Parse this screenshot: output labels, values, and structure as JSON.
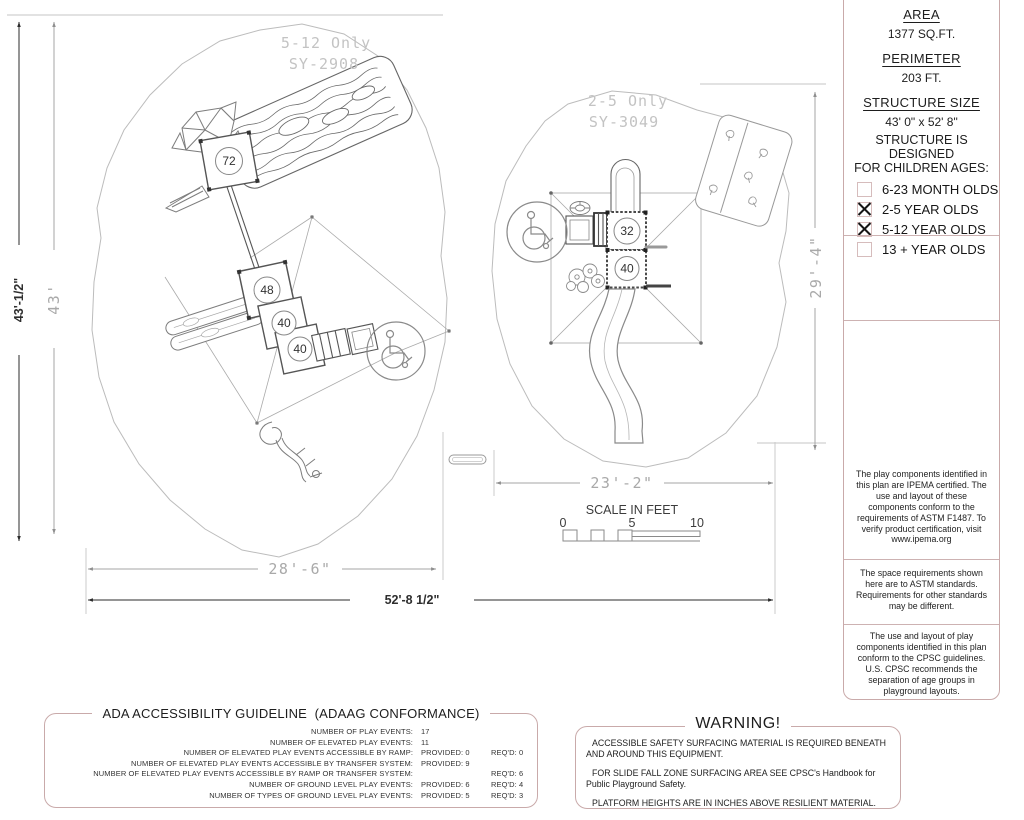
{
  "colors": {
    "box_border": "#c9aaaa",
    "drawing_gray": "#b8b8b8",
    "dim_dark": "#2e2e2e",
    "dim_gray": "#a8a8a8",
    "cad_label": "#c3c3c3"
  },
  "sidebar": {
    "area_label": "AREA",
    "area_value": "1377 SQ.FT.",
    "perimeter_label": "PERIMETER",
    "perimeter_value": "203 FT.",
    "size_label": "STRUCTURE SIZE",
    "size_value": "43' 0\" x 52' 8\"",
    "designed_line1": "STRUCTURE IS DESIGNED",
    "designed_line2": "FOR CHILDREN AGES:",
    "ages": [
      {
        "label": "6-23 MONTH OLDS",
        "checked": false
      },
      {
        "label": "2-5 YEAR OLDS",
        "checked": true
      },
      {
        "label": "5-12 YEAR OLDS",
        "checked": true
      },
      {
        "label": "13 + YEAR OLDS",
        "checked": false
      }
    ],
    "notes": [
      "The play components identified in this plan are IPEMA certified. The use and layout of these components conform to the requirements of ASTM F1487. To verify product certification, visit www.ipema.org",
      "The space requirements shown here are to ASTM standards. Requirements for other standards may be different.",
      "The use and layout of play components identified in this plan conform to the CPSC guidelines. U.S. CPSC recommends the separation of age groups in playground layouts."
    ]
  },
  "plan": {
    "structures": [
      {
        "age_label": "5-12 Only",
        "model": "SY-2908",
        "platform_heights": [
          "72",
          "48",
          "40",
          "40"
        ]
      },
      {
        "age_label": "2-5 Only",
        "model": "SY-3049",
        "platform_heights": [
          "32",
          "40"
        ]
      }
    ],
    "dimensions": {
      "left_height_overall": "43'-1/2\"",
      "left_height_inner": "43'",
      "left_width": "28'-6\"",
      "overall_width": "52'-8 1/2\"",
      "right_width": "23'-2\"",
      "right_height": "29'-4\""
    },
    "scale": {
      "title": "SCALE IN FEET",
      "ticks": [
        "0",
        "5",
        "10"
      ]
    }
  },
  "ada": {
    "title": "ADA ACCESSIBILITY GUIDELINE  (ADAAG CONFORMANCE)",
    "rows": [
      {
        "label": "NUMBER OF PLAY EVENTS:",
        "provided": "17",
        "reqd": ""
      },
      {
        "label": "NUMBER OF ELEVATED PLAY EVENTS:",
        "provided": "11",
        "reqd": ""
      },
      {
        "label": "NUMBER OF ELEVATED PLAY EVENTS ACCESSIBLE BY RAMP:",
        "provided": "PROVIDED: 0",
        "reqd": "REQ'D: 0"
      },
      {
        "label": "NUMBER OF ELEVATED PLAY EVENTS ACCESSIBLE BY TRANSFER SYSTEM:",
        "provided": "PROVIDED: 9",
        "reqd": ""
      },
      {
        "label": "NUMBER OF ELEVATED PLAY EVENTS ACCESSIBLE BY RAMP OR TRANSFER SYSTEM:",
        "provided": "",
        "reqd": "REQ'D: 6"
      },
      {
        "label": "NUMBER OF GROUND LEVEL PLAY EVENTS:",
        "provided": "PROVIDED: 6",
        "reqd": "REQ'D: 4"
      },
      {
        "label": "NUMBER OF TYPES OF GROUND LEVEL PLAY EVENTS:",
        "provided": "PROVIDED: 5",
        "reqd": "REQ'D: 3"
      }
    ]
  },
  "warning": {
    "title": "WARNING!",
    "lines": [
      "ACCESSIBLE SAFETY SURFACING MATERIAL IS REQUIRED BENEATH AND AROUND THIS EQUIPMENT.",
      "FOR SLIDE FALL ZONE SURFACING AREA SEE CPSC's Handbook for Public Playground Safety.",
      "PLATFORM HEIGHTS ARE IN INCHES ABOVE RESILIENT MATERIAL."
    ]
  }
}
